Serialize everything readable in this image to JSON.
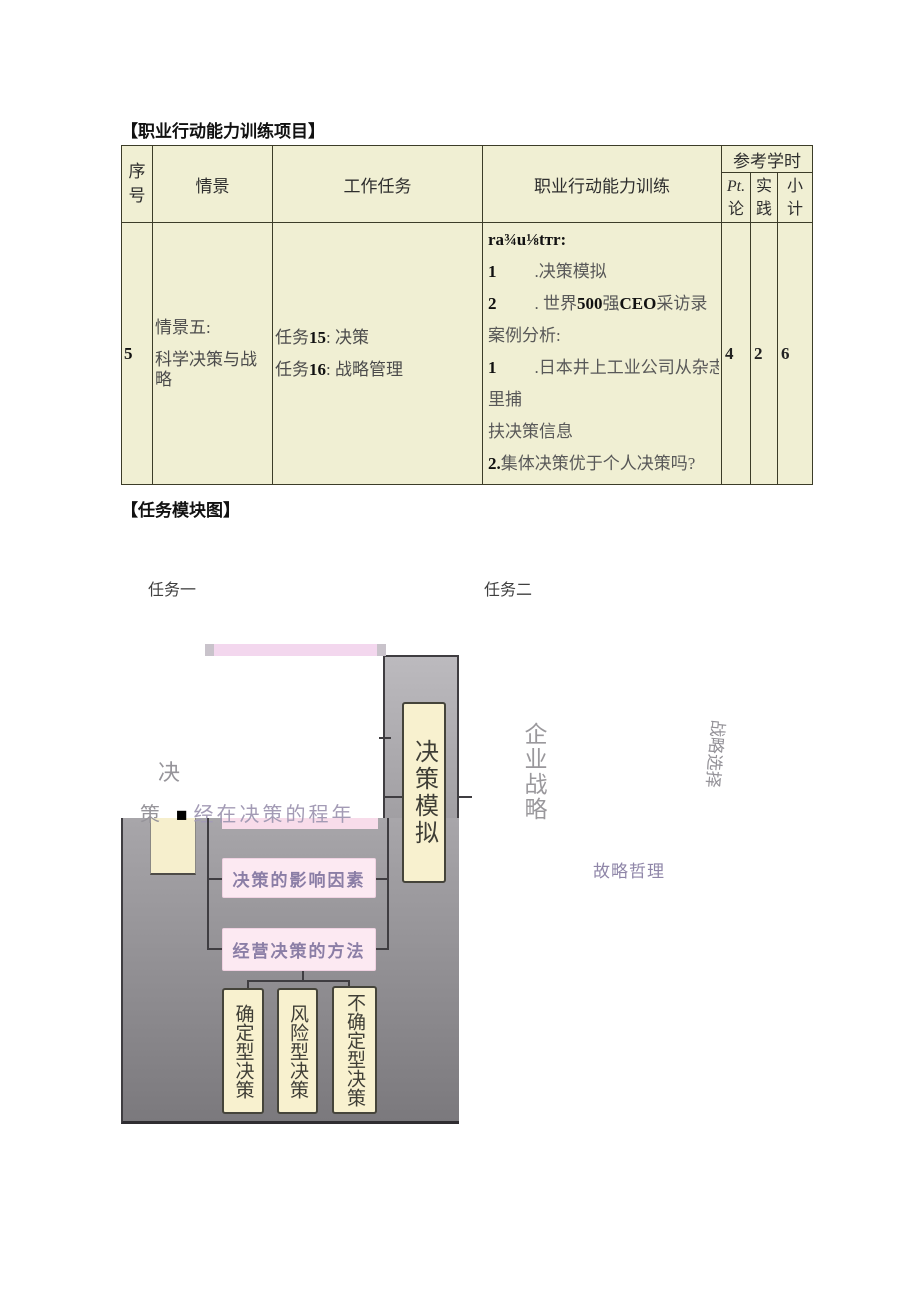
{
  "sections": {
    "training_title": "【职业行动能力训练项目】",
    "module_title": "【任务模块图】"
  },
  "table": {
    "headers": {
      "no_line1": "序",
      "no_line2": "号",
      "scene": "情景",
      "task": "工作任务",
      "training": "职业行动能力训练",
      "hours": "参考学时",
      "sub1_top": "Pt.",
      "sub1_bottom": "论",
      "sub2_top": "实",
      "sub2_bottom": "践",
      "sub3_top": "小",
      "sub3_bottom": "计"
    },
    "row": {
      "no": "5",
      "scene1": "情景五:",
      "scene2": "科学决策与战略",
      "task1_pre": "任务",
      "task1_num": "15",
      "task1_post": ": 决策",
      "task2_pre": "任务",
      "task2_num": "16",
      "task2_post": ": 战略管理",
      "training": {
        "l0": "ra¾u⅛tтr:",
        "l1_num": "1",
        "l1_text": ".决策模拟",
        "l2_num": "2",
        "l2_a": ". 世界",
        "l2_b": "500",
        "l2_c": "强",
        "l2_d": "CEO",
        "l2_e": "采访录",
        "l3": "案例分析:",
        "l4_num": "1",
        "l4_text": ".日本井上工业公司从杂志",
        "l5": "里捕",
        "l6": "扶决策信息",
        "l7_num": "2.",
        "l7_text": "集体决策优于个人决策吗?",
        "l8_num": "3",
        "l8_text": "韦尔奇的“三Pl圈”战略"
      },
      "hours_theory": "4",
      "hours_practice": "2",
      "hours_total": "6"
    }
  },
  "diagram": {
    "task1_label": "任务一",
    "task2_label": "任务二",
    "overlay": {
      "char1": "决",
      "char2": "策",
      "square": "■",
      "rest": "经在决策的程年"
    },
    "boxes": {
      "sim": "决策模拟",
      "influence": "决策的影响因素",
      "methods": "经营决策的方法",
      "certain": "确定型决策",
      "risk": "风险型决策",
      "uncertain": "不确定型决策"
    },
    "right": {
      "enterprise": "企业战略",
      "choice": "战略选择",
      "philosophy": "故略哲理"
    },
    "colors": {
      "table_bg": "#f0efd3",
      "table_border": "#3c3c28",
      "cream_box": "#f8f1cf",
      "pink_box": "#fce9f2",
      "pink_strip": "#f3d7ee",
      "purple_text": "#8b7ea6",
      "gray_top": "#bcbabe",
      "gray_bottom": "#7b797d",
      "line": "#3f3d41"
    }
  }
}
